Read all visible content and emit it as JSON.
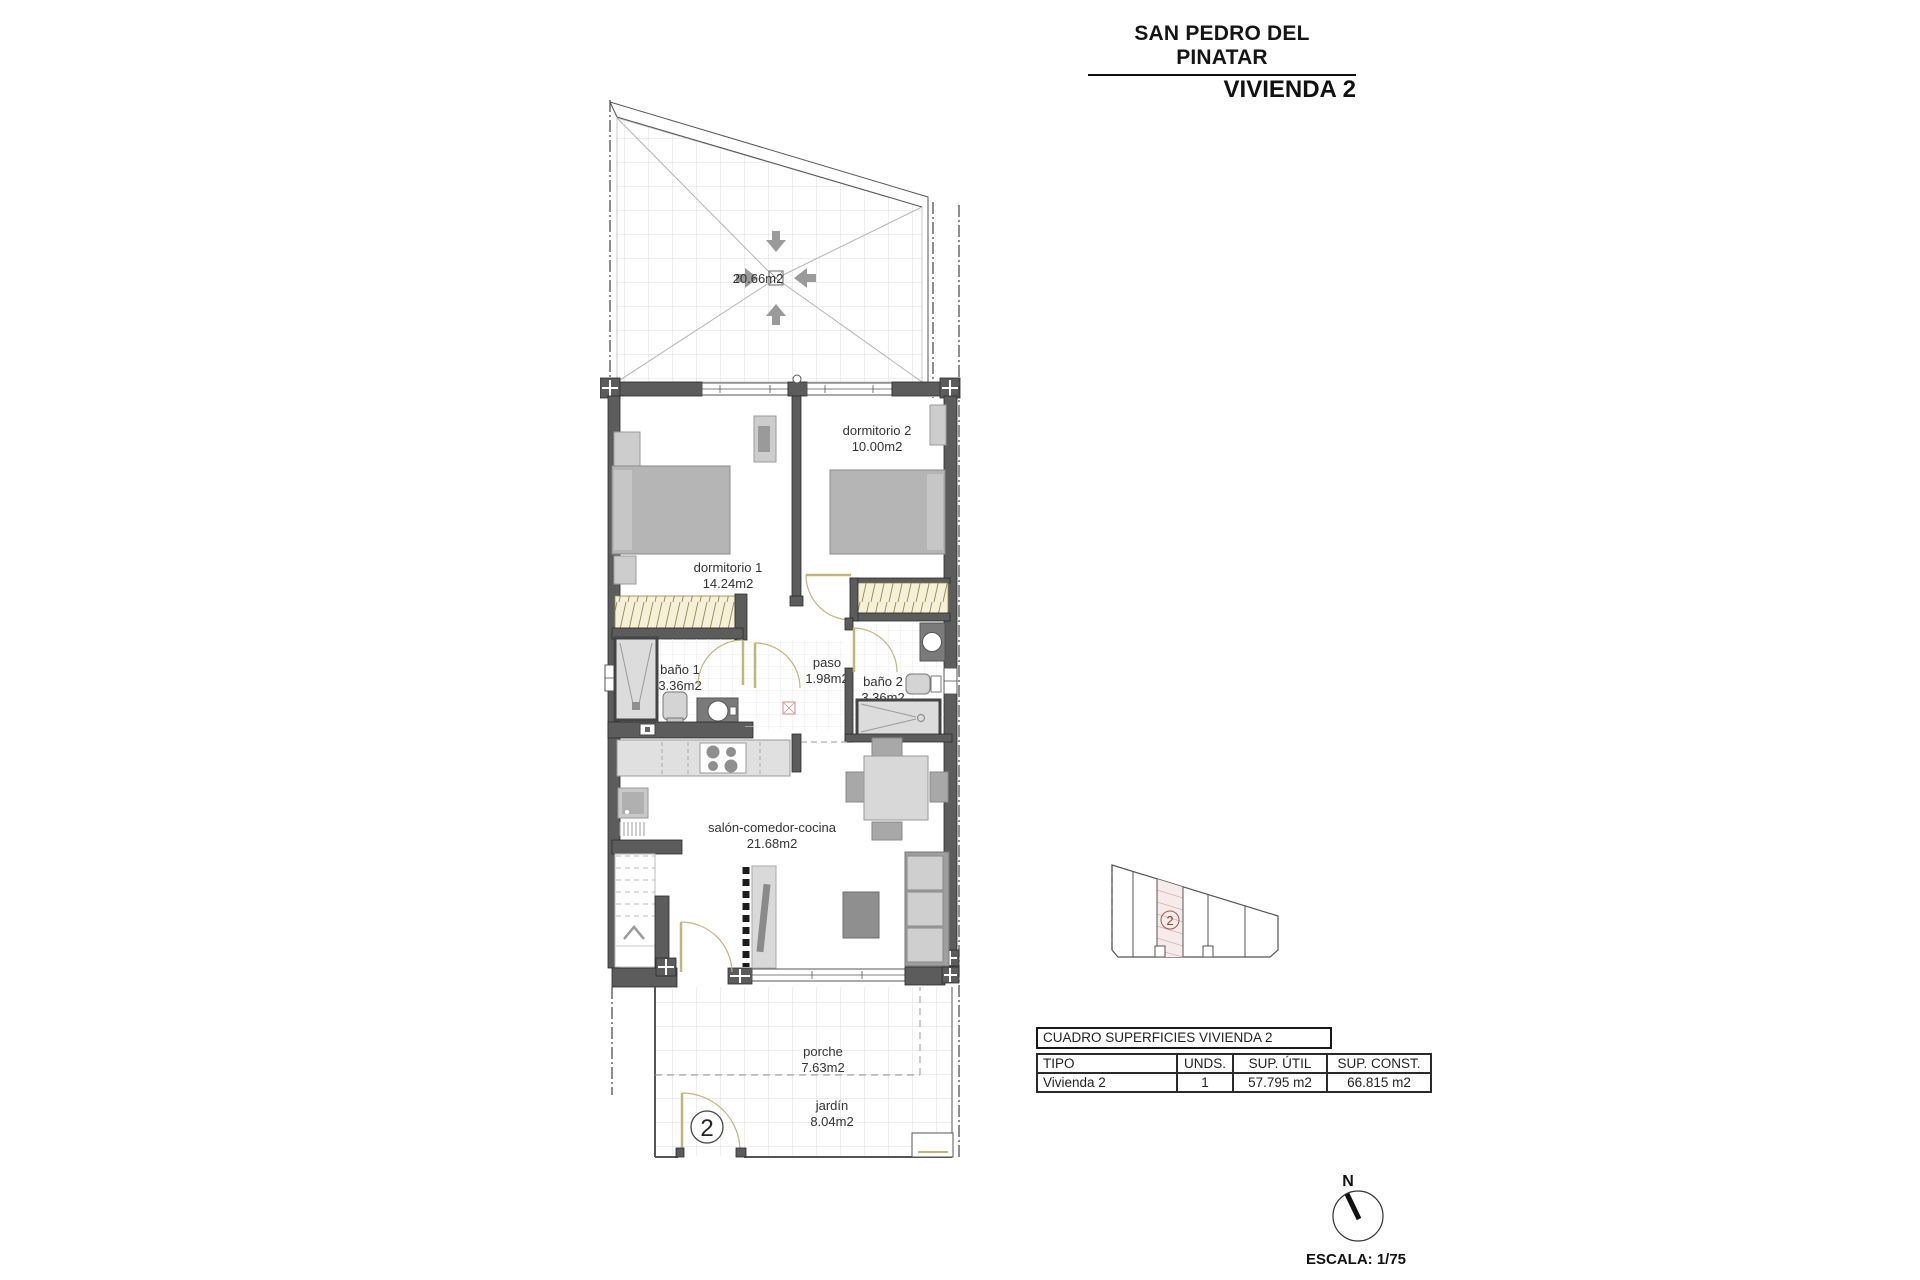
{
  "header": {
    "location": "SAN PEDRO DEL PINATAR",
    "unit": "VIVIENDA 2"
  },
  "plan": {
    "terrace": {
      "area": "20.66m2"
    },
    "rooms": {
      "dormitorio1": {
        "name": "dormitorio 1",
        "area": "14.24m2"
      },
      "dormitorio2": {
        "name": "dormitorio 2",
        "area": "10.00m2"
      },
      "bano1": {
        "name": "baño 1",
        "area": "3.36m2"
      },
      "paso": {
        "name": "paso",
        "area": "1.98m2"
      },
      "bano2": {
        "name": "baño 2",
        "area": "3.36m2"
      },
      "salon": {
        "name": "salón-comedor-cocina",
        "area": "21.68m2"
      },
      "porche": {
        "name": "porche",
        "area": "7.63m2"
      },
      "jardin": {
        "name": "jardín",
        "area": "8.04m2"
      }
    },
    "entrance_number": "2"
  },
  "site_plan": {
    "unit_number": "2"
  },
  "table": {
    "title": "CUADRO SUPERFICIES VIVIENDA 2",
    "columns": [
      "TIPO",
      "UNDS.",
      "SUP. ÚTIL",
      "SUP. CONST."
    ],
    "rows": [
      [
        "Vivienda 2",
        "1",
        "57.795 m2",
        "66.815 m2"
      ]
    ]
  },
  "compass": {
    "north_label": "N"
  },
  "scale": {
    "label": "ESCALA: 1/75"
  },
  "colors": {
    "wall": "#5c5c5c",
    "door": "#c3b47c",
    "wardrobe_hatch": "#f6f0d8",
    "site_highlight": "#f7ebea",
    "site_accent": "#7d453c",
    "furniture": "#b5b5b5"
  }
}
